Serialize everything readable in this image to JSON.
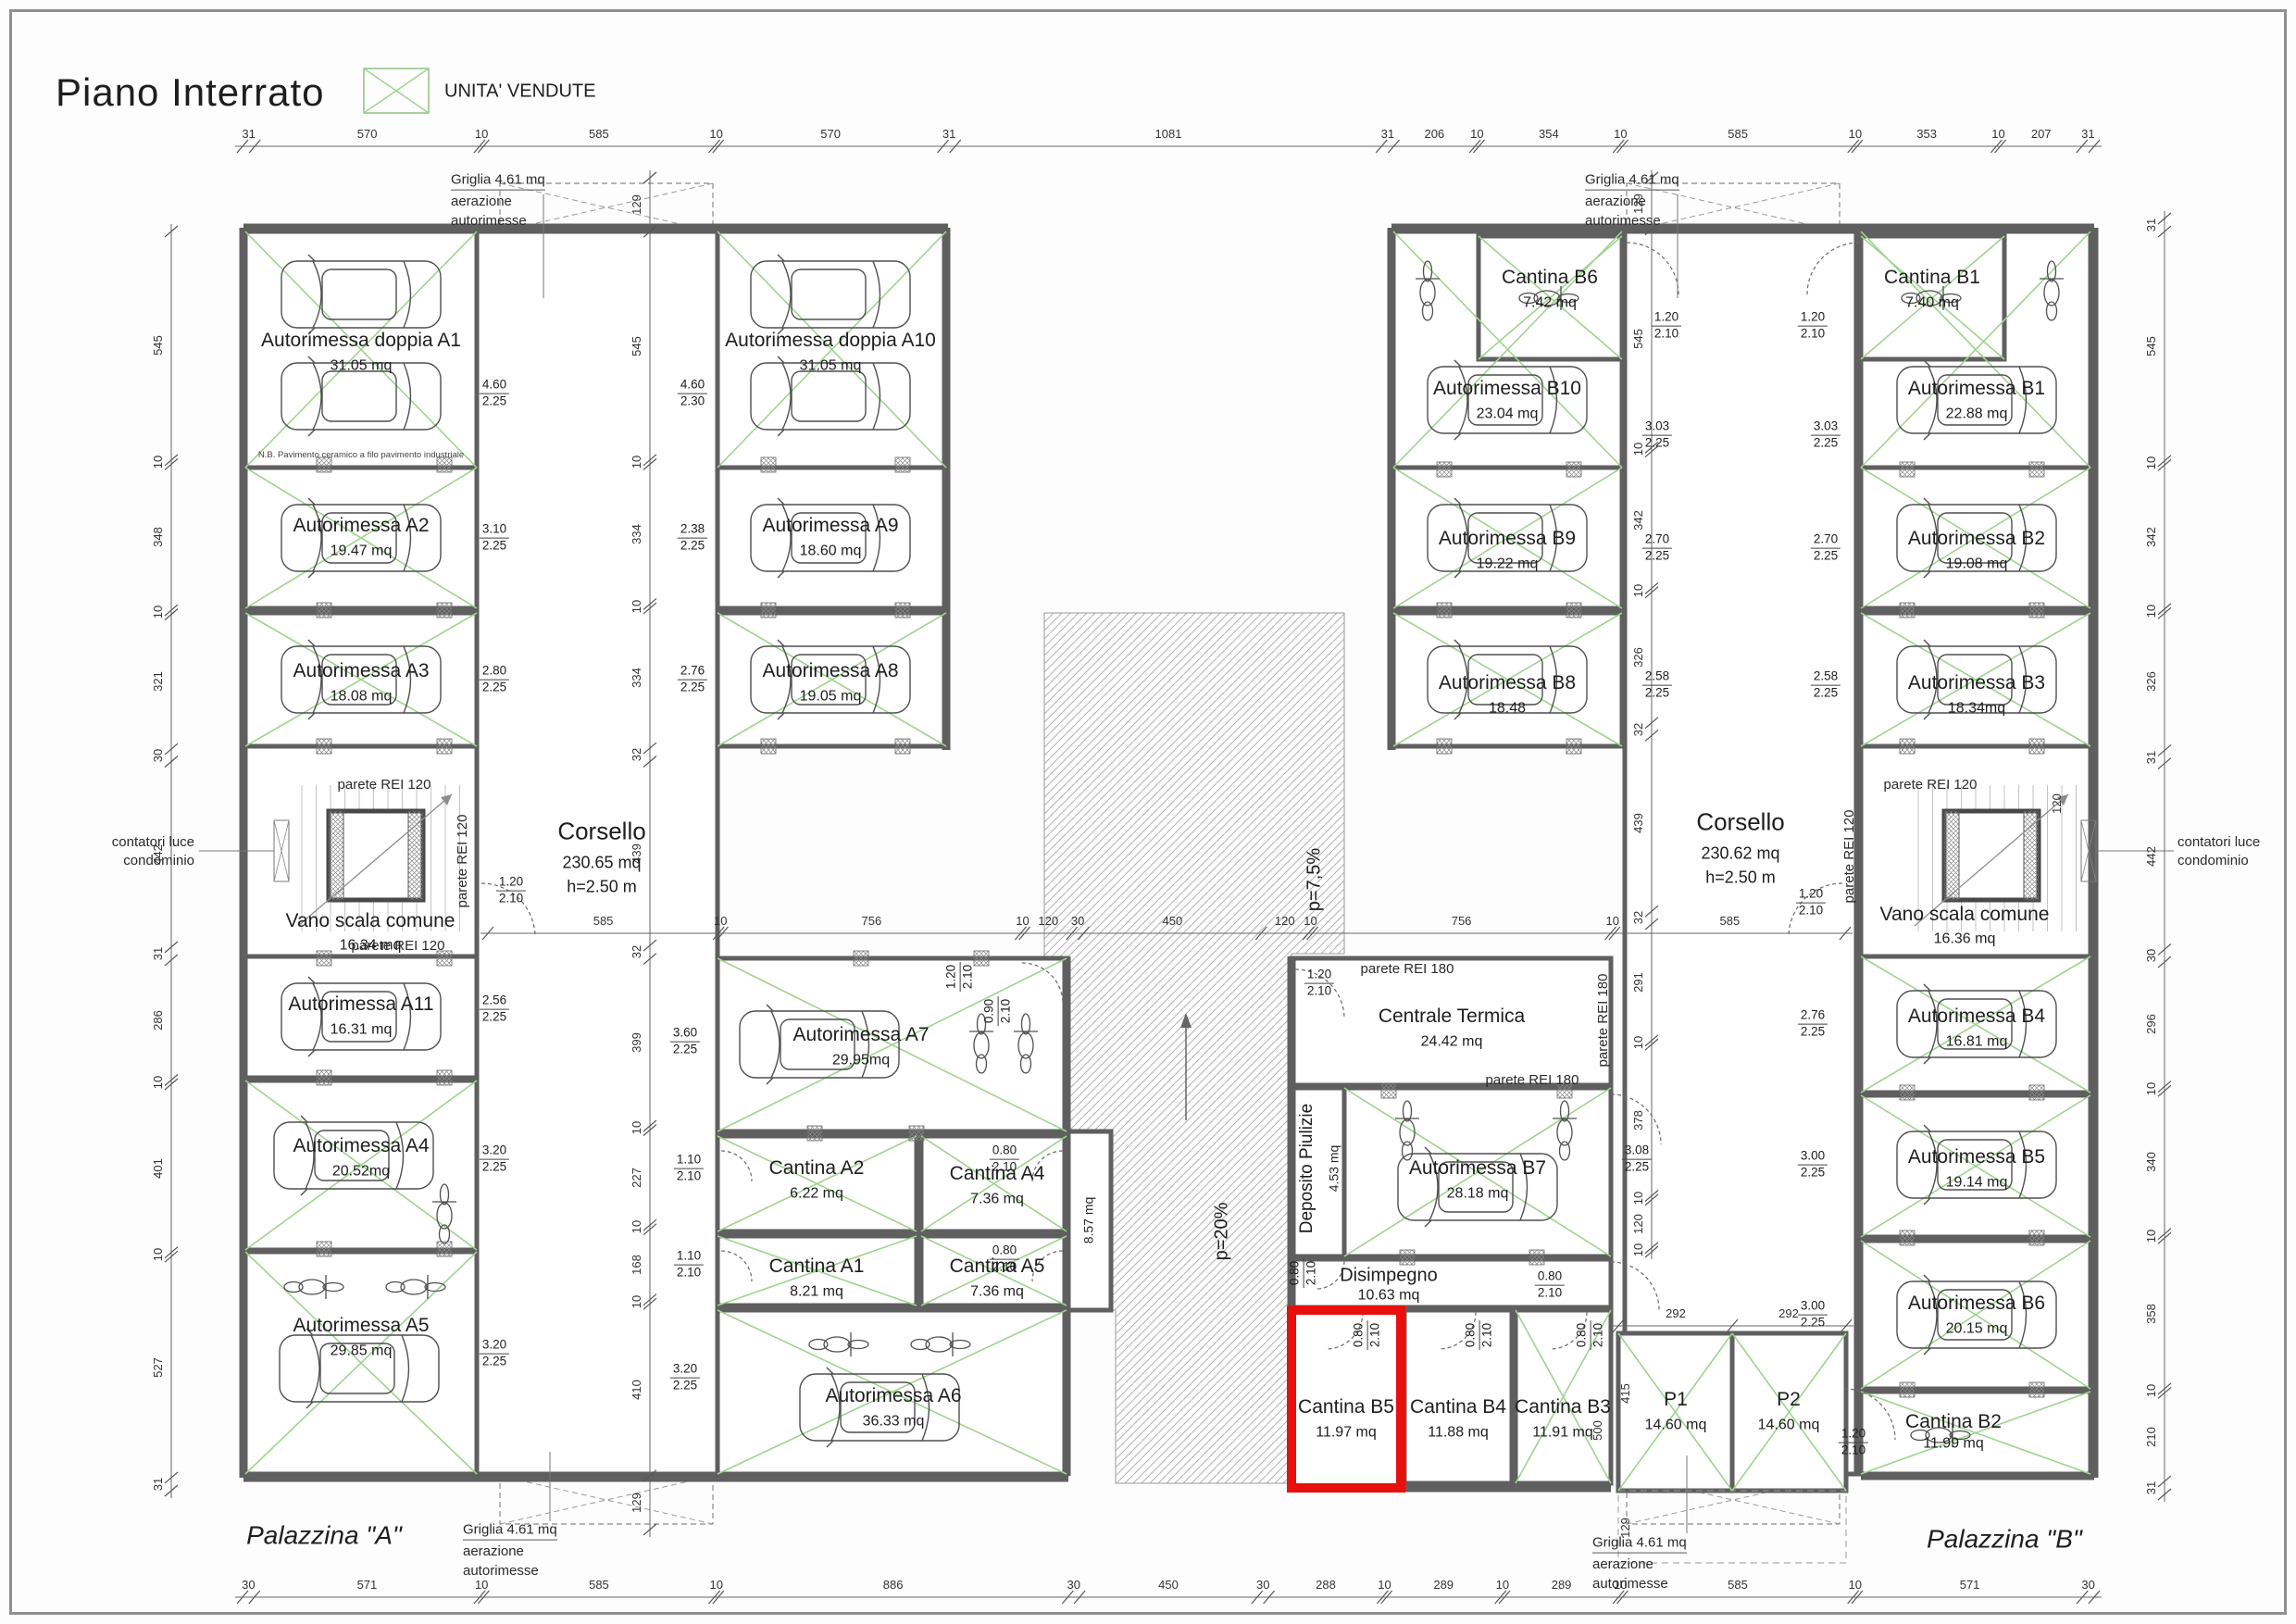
{
  "sheet": {
    "title": "Piano Interrato",
    "legend_label": "UNITA' VENDUTE",
    "palazzina_a": "Palazzina \"A\"",
    "palazzina_b": "Palazzina \"B\""
  },
  "colors": {
    "sold_green": "#9ed48e",
    "wall_gray": "#5f5f5f",
    "highlight_red": "#e8100c"
  },
  "griglia": {
    "l1": "Griglia  4.61 mq",
    "l2": "aerazione",
    "l3": "autorimesse"
  },
  "ann": {
    "corsello_a_name": "Corsello",
    "corsello_a_area": "230.65 mq",
    "corsello_a_h": "h=2.50 m",
    "corsello_b_name": "Corsello",
    "corsello_b_area": "230.62 mq",
    "corsello_b_h": "h=2.50 m",
    "vano_a_name": "Vano scala comune",
    "vano_a_area": "16.34 mq",
    "vano_b_name": "Vano scala comune",
    "vano_b_area": "16.36 mq",
    "contatori_l1": "contatori luce",
    "contatori_l2": "condominio",
    "rei120": "parete REI 120",
    "rei180": "parete REI 180",
    "dim120": "120",
    "note_a1": "N.B. Pavimento ceramico a filo pavimento industriale",
    "corr857": "8.57 mq",
    "ramp_upper": "p=7,5%",
    "ramp_lower": "p=20%"
  },
  "rooms": {
    "a1": {
      "name": "Autorimessa doppia A1",
      "area": "31.05 mq",
      "sold": true
    },
    "a2": {
      "name": "Autorimessa A2",
      "area": "19.47 mq",
      "sold": true
    },
    "a3": {
      "name": "Autorimessa A3",
      "area": "18.08 mq",
      "sold": true
    },
    "a10": {
      "name": "Autorimessa doppia A10",
      "area": "31.05 mq",
      "sold": true
    },
    "a9": {
      "name": "Autorimessa A9",
      "area": "18.60 mq",
      "sold": false
    },
    "a8": {
      "name": "Autorimessa A8",
      "area": "19.05 mq",
      "sold": true
    },
    "a11": {
      "name": "Autorimessa A11",
      "area": "16.31 mq",
      "sold": false
    },
    "a4": {
      "name": "Autorimessa A4",
      "area": "20.52mq",
      "sold": true
    },
    "a5": {
      "name": "Autorimessa A5",
      "area": "29.85 mq",
      "sold": true
    },
    "a7": {
      "name": "Autorimessa A7",
      "area": "29.95mq",
      "sold": true
    },
    "ca2": {
      "name": "Cantina A2",
      "area": "6.22 mq",
      "sold": true
    },
    "ca4": {
      "name": "Cantina A4",
      "area": "7.36 mq",
      "sold": true
    },
    "ca1": {
      "name": "Cantina A1",
      "area": "8.21 mq",
      "sold": true
    },
    "ca5": {
      "name": "Cantina A5",
      "area": "7.36 mq",
      "sold": true
    },
    "a6": {
      "name": "Autorimessa A6",
      "area": "36.33 mq",
      "sold": true
    },
    "cb6": {
      "name": "Cantina B6",
      "area": "7.42 mq",
      "sold": true
    },
    "b10": {
      "name": "Autorimessa B10",
      "area": "23.04 mq",
      "sold": true
    },
    "b9": {
      "name": "Autorimessa B9",
      "area": "19.22 mq",
      "sold": true
    },
    "b8": {
      "name": "Autorimessa B8",
      "area": "18.48",
      "sold": true
    },
    "cb1": {
      "name": "Cantina B1",
      "area": "7.40 mq",
      "sold": true
    },
    "b1": {
      "name": "Autorimessa B1",
      "area": "22.88 mq",
      "sold": true
    },
    "b2": {
      "name": "Autorimessa B2",
      "area": "19.08 mq",
      "sold": true
    },
    "b3": {
      "name": "Autorimessa B3",
      "area": "18.34mq",
      "sold": true
    },
    "ct": {
      "name": "Centrale Termica",
      "area": "24.42 mq",
      "sold": false
    },
    "dep": {
      "name": "Deposito Piulizie",
      "area": "4.53 mq",
      "sold": false
    },
    "b7": {
      "name": "Autorimessa B7",
      "area": "28.18 mq",
      "sold": true
    },
    "dis": {
      "name": "Disimpegno",
      "area": "10.63 mq",
      "sold": false
    },
    "cb5": {
      "name": "Cantina B5",
      "area": "11.97 mq",
      "sold": false,
      "highlighted": true
    },
    "cb4": {
      "name": "Cantina B4",
      "area": "11.88 mq",
      "sold": false
    },
    "cb3": {
      "name": "Cantina B3",
      "area": "11.91 mq",
      "sold": true
    },
    "p1": {
      "name": "P1",
      "area": "14.60 mq",
      "sold": true
    },
    "p2": {
      "name": "P2",
      "area": "14.60 mq",
      "sold": true
    },
    "b4": {
      "name": "Autorimessa B4",
      "area": "16.81 mq",
      "sold": true
    },
    "b5": {
      "name": "Autorimessa B5",
      "area": "19.14 mq",
      "sold": true
    },
    "b6": {
      "name": "Autorimessa B6",
      "area": "20.15 mq",
      "sold": true
    },
    "cb2": {
      "name": "Cantina B2",
      "area": "11.99 mq",
      "sold": true
    }
  },
  "fractions": {
    "f460_225": [
      "4.60",
      "2.25"
    ],
    "f460_230": [
      "4.60",
      "2.30"
    ],
    "f310_225": [
      "3.10",
      "2.25"
    ],
    "f280_225": [
      "2.80",
      "2.25"
    ],
    "f238_225": [
      "2.38",
      "2.25"
    ],
    "f276_225": [
      "2.76",
      "2.25"
    ],
    "f303_225": [
      "3.03",
      "2.25"
    ],
    "f270_225": [
      "2.70",
      "2.25"
    ],
    "f258_225": [
      "2.58",
      "2.25"
    ],
    "f256_225": [
      "2.56",
      "2.25"
    ],
    "f320_225": [
      "3.20",
      "2.25"
    ],
    "f360_225": [
      "3.60",
      "2.25"
    ],
    "f308_225": [
      "3.08",
      "2.25"
    ],
    "f300_225": [
      "3.00",
      "2.25"
    ],
    "f120_210": [
      "1.20",
      "2.10"
    ],
    "f110_210": [
      "1.10",
      "2.10"
    ],
    "f080_210": [
      "0.80",
      "2.10"
    ],
    "f090_210": [
      "0.90",
      "2.10"
    ]
  },
  "chains": {
    "top": [
      "31",
      "570",
      "10",
      "585",
      "10",
      "570",
      "31",
      "1081",
      "31",
      "206",
      "10",
      "354",
      "10",
      "585",
      "10",
      "353",
      "10",
      "207",
      "31"
    ],
    "bottom": [
      "30",
      "571",
      "10",
      "585",
      "10",
      "886",
      "30",
      "450",
      "30",
      "288",
      "10",
      "289",
      "10",
      "289",
      "10",
      "585",
      "10",
      "571",
      "30"
    ],
    "left": [
      "545",
      "10",
      "348",
      "10",
      "321",
      "30",
      "442",
      "31",
      "286",
      "10",
      "401",
      "10",
      "527",
      "31"
    ],
    "right": [
      "31",
      "545",
      "10",
      "342",
      "10",
      "326",
      "31",
      "442",
      "30",
      "296",
      "10",
      "340",
      "10",
      "358",
      "10",
      "210",
      "31"
    ],
    "middle": [
      "585",
      "10",
      "756",
      "10",
      "120",
      "30",
      "450",
      "120",
      "10",
      "756",
      "10",
      "585"
    ],
    "innerA": [
      "129",
      "545",
      "10",
      "334",
      "10",
      "334",
      "32",
      "439",
      "32",
      "399",
      "10",
      "227",
      "10",
      "168",
      "10",
      "410",
      "129"
    ],
    "innerB": [
      "129",
      "545",
      "10",
      "342",
      "10",
      "326",
      "32",
      "439",
      "32",
      "291",
      "10",
      "378",
      "10",
      "120",
      "10"
    ],
    "parea": [
      "292",
      "292",
      "415",
      "500",
      "129"
    ]
  }
}
